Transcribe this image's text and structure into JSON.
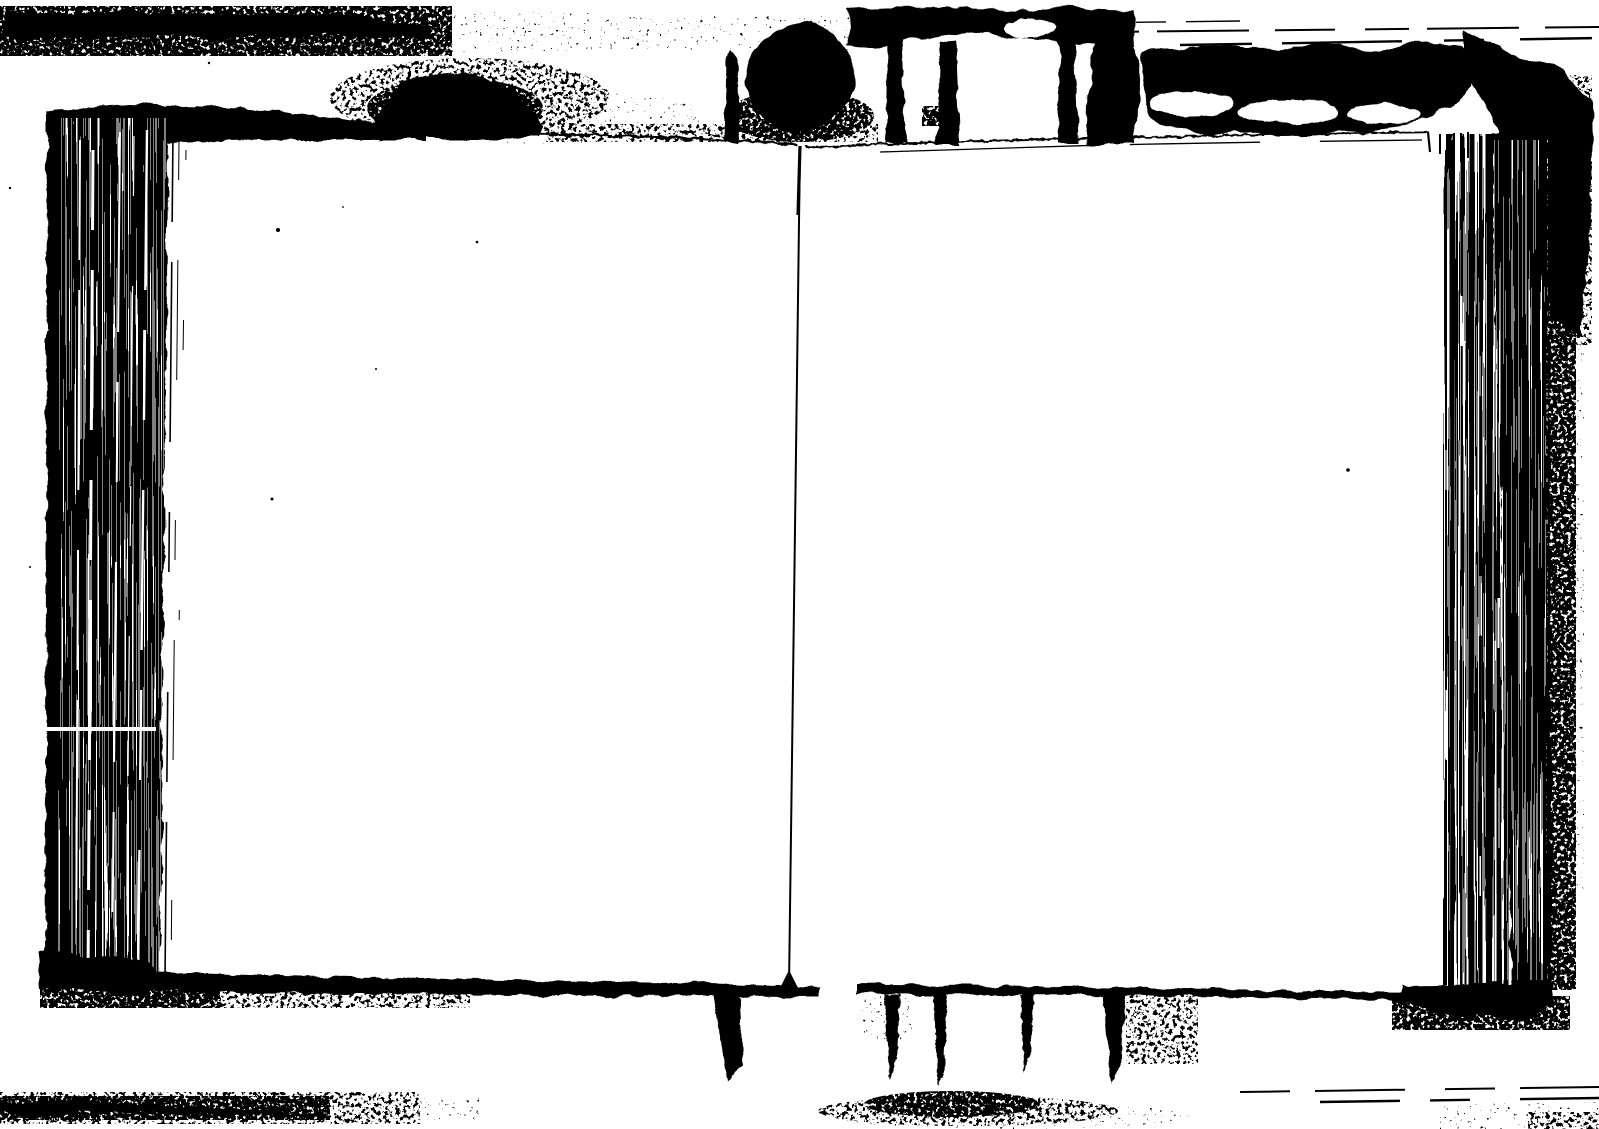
{
  "scan": {
    "description": "Black-and-white photocopy scan of an open book with two blank facing pages",
    "colors": {
      "paper": "#ffffff",
      "ink": "#000000"
    },
    "left_page": {
      "content": ""
    },
    "right_page": {
      "content": ""
    }
  }
}
